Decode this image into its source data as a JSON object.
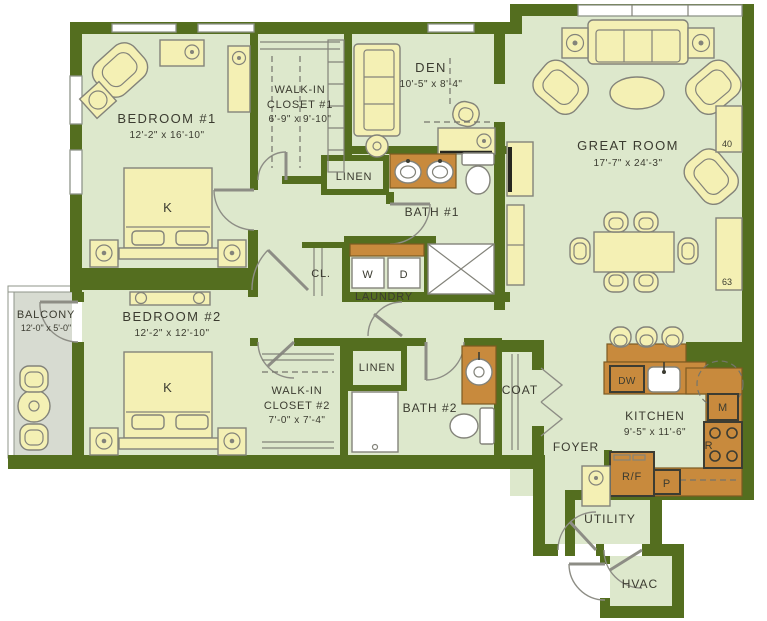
{
  "colors": {
    "wall": "#546e1f",
    "floor": "#dde8cc",
    "balcony_floor": "#d7dbd1",
    "furniture": "#f4f0b4",
    "furniture_outline": "#83837a",
    "counter": "#c88a3d",
    "counter_outline": "#7c5a22",
    "appliance_outline": "#3c3c32",
    "door": "#8d8d85",
    "dash": "#75756b",
    "window_frame": "#8f948a",
    "text": "#3b3b30"
  },
  "plan": {
    "rooms": {
      "bedroom1": {
        "name": "BEDROOM #1",
        "dims": "12'-2\" x 16'-10\""
      },
      "bedroom2": {
        "name": "BEDROOM #2",
        "dims": "12'-2\" x 12'-10\""
      },
      "wic1": {
        "line1": "WALK-IN",
        "line2": "CLOSET #1",
        "dims": "6'-9\" x 9'-10\""
      },
      "wic2": {
        "line1": "WALK-IN",
        "line2": "CLOSET #2",
        "dims": "7'-0\" x 7'-4\""
      },
      "den": {
        "name": "DEN",
        "dims": "10'-5\" x 8'-4\""
      },
      "great_room": {
        "name": "GREAT ROOM",
        "dims": "17'-7\" x 24'-3\""
      },
      "bath1": {
        "name": "BATH #1"
      },
      "bath2": {
        "name": "BATH #2"
      },
      "linen1": {
        "name": "LINEN"
      },
      "linen2": {
        "name": "LINEN"
      },
      "closet": {
        "name": "CL."
      },
      "laundry": {
        "name": "LAUNDRY",
        "washer": "W",
        "dryer": "D"
      },
      "balcony": {
        "name": "BALCONY",
        "dims": "12'-0\" x 5'-0\""
      },
      "coat": {
        "name": "COAT"
      },
      "foyer": {
        "name": "FOYER"
      },
      "kitchen": {
        "name": "KITCHEN",
        "dims": "9'-5\" x 11'-6\"",
        "appliances": {
          "dw": "DW",
          "microwave": "M",
          "range": "R",
          "fridge": "R/F",
          "pantry": "P"
        }
      },
      "utility": {
        "name": "UTILITY"
      },
      "hvac": {
        "name": "HVAC"
      }
    },
    "furniture": {
      "king_bed_label": "K"
    },
    "annotations": {
      "note40": "40",
      "note63": "63"
    }
  }
}
